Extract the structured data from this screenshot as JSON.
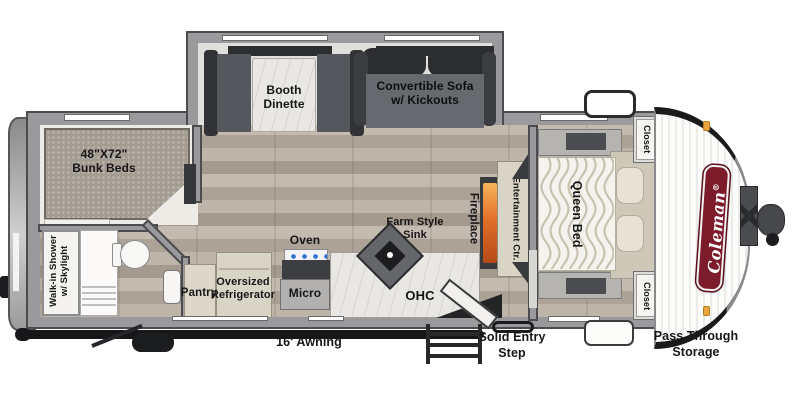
{
  "brand": {
    "name": "Coleman",
    "registered": "®"
  },
  "labels": {
    "bunk": {
      "l1": "48\"X72\"",
      "l2": "Bunk Beds"
    },
    "dinette": {
      "l1": "Booth",
      "l2": "Dinette"
    },
    "sofa": {
      "l1": "Convertible Sofa",
      "l2": "w/ Kickouts"
    },
    "shower": {
      "l1": "Walk-in Shower",
      "l2": "w/ Skylight"
    },
    "pantry": "Pantry",
    "fridge": {
      "l1": "Oversized",
      "l2": "Refrigerator"
    },
    "oven": "Oven",
    "micro": "Micro",
    "sink": {
      "l1": "Farm Style",
      "l2": "Sink"
    },
    "ohc": "OHC",
    "fireplace": "Fireplace",
    "entertainment_center": "Entertainment Ctr.",
    "queen_bed": "Queen Bed",
    "closet_front_top": "Closet",
    "closet_front_bottom": "Closet",
    "awning": "16' Awning",
    "entry_step": {
      "l1": "Solid Entry",
      "l2": "Step"
    },
    "storage": {
      "l1": "Pass Through",
      "l2": "Storage"
    }
  },
  "colors": {
    "brand_red": "#7c1c2b",
    "fireplace_orange": "#e2702a",
    "marker_light_orange": "#eaa43d",
    "wall_gray": "#9a9a9c",
    "floor_wood": "#b2a99d"
  }
}
